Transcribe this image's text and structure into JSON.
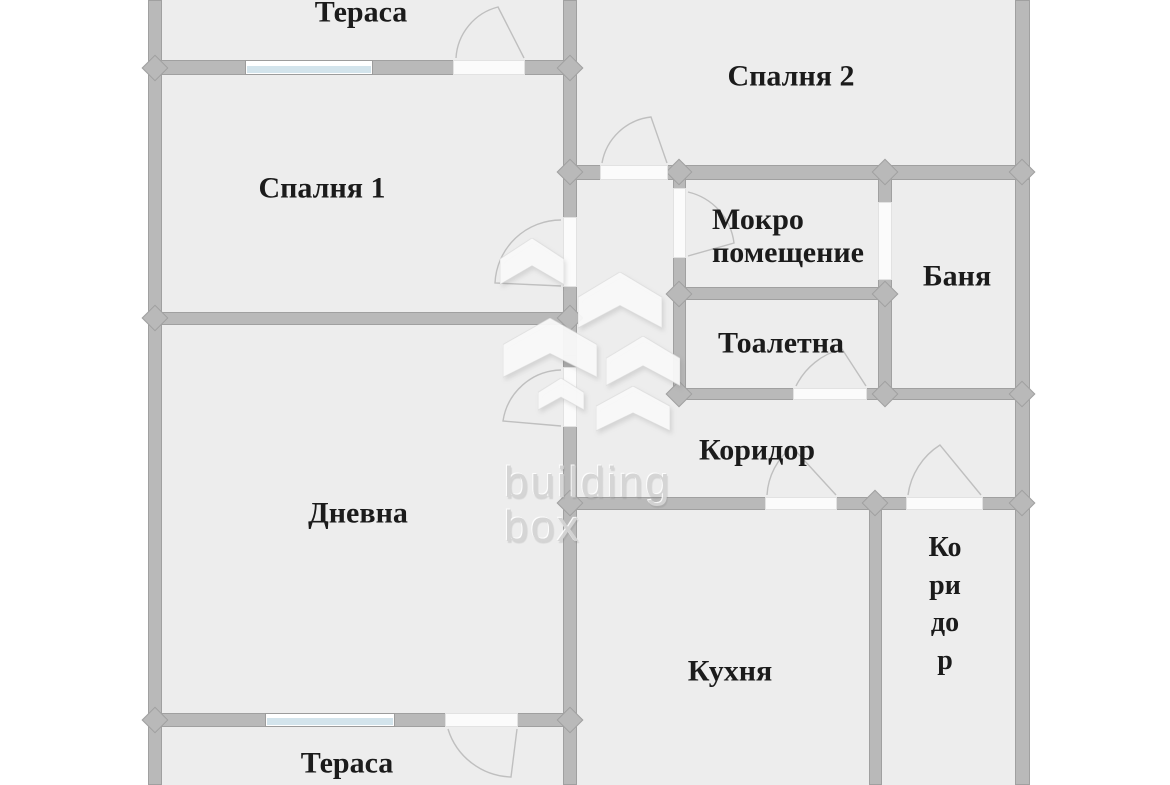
{
  "plan": {
    "canvas": {
      "width": 1170,
      "height": 785
    },
    "colors": {
      "background": "#ffffff",
      "floor": "#ededed",
      "wall": "#b9b9b9",
      "wall_border": "#a0a0a0",
      "window_glass": "#d3e4ec",
      "door_arc": "#bfbfbf",
      "label_text": "#1b1b1b",
      "watermark": "#d4d4d4"
    },
    "floor": {
      "x": 148,
      "y": 0,
      "w": 882,
      "h": 785
    },
    "walls": [
      {
        "x": 148,
        "y": 0,
        "w": 14,
        "h": 785
      },
      {
        "x": 1015,
        "y": 0,
        "w": 15,
        "h": 785
      },
      {
        "x": 563,
        "y": 0,
        "w": 14,
        "h": 785
      },
      {
        "x": 148,
        "y": 60,
        "w": 429,
        "h": 15
      },
      {
        "x": 148,
        "y": 312,
        "w": 429,
        "h": 13
      },
      {
        "x": 148,
        "y": 713,
        "w": 429,
        "h": 14
      },
      {
        "x": 563,
        "y": 165,
        "w": 467,
        "h": 15
      },
      {
        "x": 673,
        "y": 287,
        "w": 219,
        "h": 13
      },
      {
        "x": 673,
        "y": 388,
        "w": 357,
        "h": 12
      },
      {
        "x": 563,
        "y": 497,
        "w": 467,
        "h": 13
      },
      {
        "x": 673,
        "y": 165,
        "w": 13,
        "h": 235
      },
      {
        "x": 878,
        "y": 165,
        "w": 14,
        "h": 235
      },
      {
        "x": 869,
        "y": 497,
        "w": 13,
        "h": 288
      }
    ],
    "jamb": {
      "x": 563,
      "y": 355,
      "w": 14,
      "h": 13
    },
    "joints": [
      {
        "cx": 155,
        "cy": 68
      },
      {
        "cx": 155,
        "cy": 318
      },
      {
        "cx": 155,
        "cy": 720
      },
      {
        "cx": 570,
        "cy": 68
      },
      {
        "cx": 570,
        "cy": 172
      },
      {
        "cx": 570,
        "cy": 318
      },
      {
        "cx": 570,
        "cy": 503
      },
      {
        "cx": 570,
        "cy": 720
      },
      {
        "cx": 1022,
        "cy": 172
      },
      {
        "cx": 1022,
        "cy": 394
      },
      {
        "cx": 1022,
        "cy": 503
      },
      {
        "cx": 679,
        "cy": 172
      },
      {
        "cx": 679,
        "cy": 294
      },
      {
        "cx": 679,
        "cy": 394
      },
      {
        "cx": 885,
        "cy": 172
      },
      {
        "cx": 885,
        "cy": 294
      },
      {
        "cx": 885,
        "cy": 394
      },
      {
        "cx": 875,
        "cy": 503
      }
    ],
    "openings": [
      {
        "x": 453,
        "y": 60,
        "w": 72,
        "h": 15
      },
      {
        "x": 445,
        "y": 713,
        "w": 73,
        "h": 14
      },
      {
        "x": 563,
        "y": 217,
        "w": 14,
        "h": 70
      },
      {
        "x": 563,
        "y": 367,
        "w": 14,
        "h": 60
      },
      {
        "x": 600,
        "y": 165,
        "w": 68,
        "h": 15
      },
      {
        "x": 673,
        "y": 188,
        "w": 13,
        "h": 70
      },
      {
        "x": 878,
        "y": 202,
        "w": 14,
        "h": 78
      },
      {
        "x": 793,
        "y": 388,
        "w": 74,
        "h": 12
      },
      {
        "x": 765,
        "y": 497,
        "w": 72,
        "h": 13
      },
      {
        "x": 906,
        "y": 497,
        "w": 77,
        "h": 13
      }
    ],
    "windows": [
      {
        "x": 245,
        "y": 60,
        "w": 128,
        "h": 15
      },
      {
        "x": 265,
        "y": 713,
        "w": 130,
        "h": 14
      }
    ],
    "door_arcs": [
      "M 456 58 A 56 56 0 0 1 498 7 L 524 58",
      "M 448 729 A 68 68 0 0 0 511 777 L 517 729",
      "M 561 220 A 66 66 0 0 0 495 283 L 561 286",
      "M 561 370 A 60 60 0 0 0 503 421 L 561 426",
      "M 602 163 A 56 56 0 0 1 651 117 L 667 163",
      "M 688 192 A 60 60 0 0 1 734 243 L 688 256",
      "M 796 386 A 70 70 0 0 1 842 349 L 866 386",
      "M 767 495 A 66 66 0 0 1 792 447 L 836 495",
      "M 908 495 A 70 70 0 0 1 940 445 L 981 495"
    ],
    "rooms": [
      {
        "id": "terasa-top",
        "label": "Тераса",
        "cx": 361,
        "cy": 12
      },
      {
        "id": "spalnya-1",
        "label": "Спалня 1",
        "cx": 322,
        "cy": 188
      },
      {
        "id": "spalnya-2",
        "label": "Спалня 2",
        "cx": 791,
        "cy": 76
      },
      {
        "id": "mokro-pomeshtenie",
        "label": "Мокро\nпомещение",
        "align": "left",
        "lx": 712,
        "ty": 203
      },
      {
        "id": "banya",
        "label": "Баня",
        "cx": 957,
        "cy": 276
      },
      {
        "id": "toaletna",
        "label": "Тоалетна",
        "cx": 781,
        "cy": 343
      },
      {
        "id": "koridor",
        "label": "Коридор",
        "cx": 757,
        "cy": 450
      },
      {
        "id": "dnevna",
        "label": "Дневна",
        "cx": 358,
        "cy": 513
      },
      {
        "id": "kuhnya",
        "label": "Кухня",
        "cx": 730,
        "cy": 671
      },
      {
        "id": "koridor-vertical",
        "label": "Коридор",
        "vertical": true,
        "lx": 927,
        "ty": 529
      },
      {
        "id": "terasa-bottom",
        "label": "Тераса",
        "cx": 347,
        "cy": 763
      }
    ],
    "watermark": {
      "line1": "building",
      "line2": "box",
      "text_x": 504,
      "text_y1": 458,
      "text_y2": 502,
      "logo_shapes": [
        {
          "x": 500,
          "y": 238,
          "w": 64,
          "h": 58
        },
        {
          "x": 578,
          "y": 272,
          "w": 84,
          "h": 70
        },
        {
          "x": 503,
          "y": 318,
          "w": 94,
          "h": 74
        },
        {
          "x": 606,
          "y": 336,
          "w": 74,
          "h": 62
        },
        {
          "x": 538,
          "y": 378,
          "w": 46,
          "h": 40
        },
        {
          "x": 596,
          "y": 386,
          "w": 74,
          "h": 56
        }
      ]
    }
  }
}
